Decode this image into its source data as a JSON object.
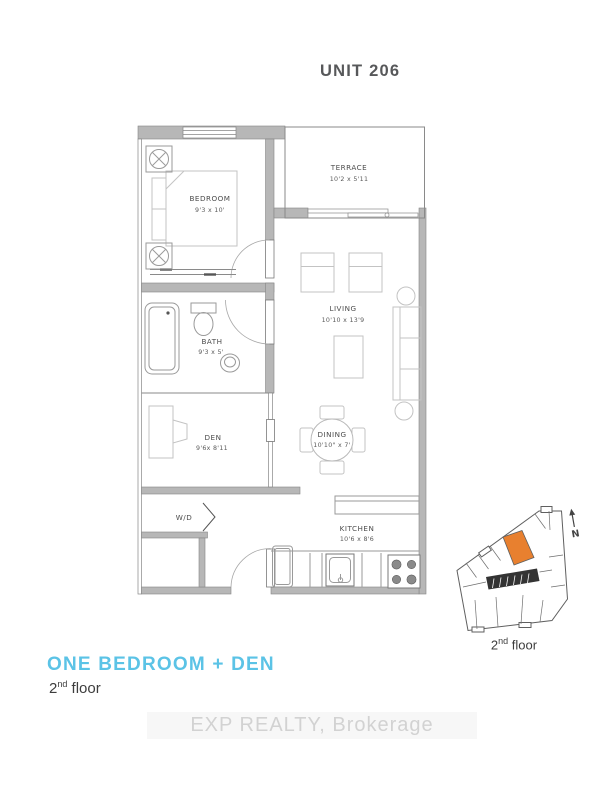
{
  "header": {
    "title": "UNIT 206"
  },
  "plan": {
    "rooms": [
      {
        "name": "BEDROOM",
        "dims": "9'3 x 10'"
      },
      {
        "name": "TERRACE",
        "dims": "10'2 x 5'11"
      },
      {
        "name": "LIVING",
        "dims": "10'10 x 13'9"
      },
      {
        "name": "BATH",
        "dims": "9'3 x 5'"
      },
      {
        "name": "DEN",
        "dims": "9'6x 8'11"
      },
      {
        "name": "DINING",
        "dims": "10'10\" x 7'"
      },
      {
        "name": "KITCHEN",
        "dims": "10'6 x 8'6"
      },
      {
        "name": "WD",
        "label": "W/D"
      }
    ]
  },
  "footer": {
    "plan_name": "ONE BEDROOM + DEN",
    "floor_num": "2",
    "floor_sup": "nd",
    "floor_word": "floor"
  },
  "keyplan": {
    "caption_num": "2",
    "caption_sup": "nd",
    "caption_word": "floor",
    "north": "N"
  },
  "watermark": {
    "text": "EXP REALTY, Brokerage"
  },
  "colors": {
    "accent": "#5BC3E6",
    "highlight": "#E8802F",
    "wall": "#b7b7b7"
  }
}
